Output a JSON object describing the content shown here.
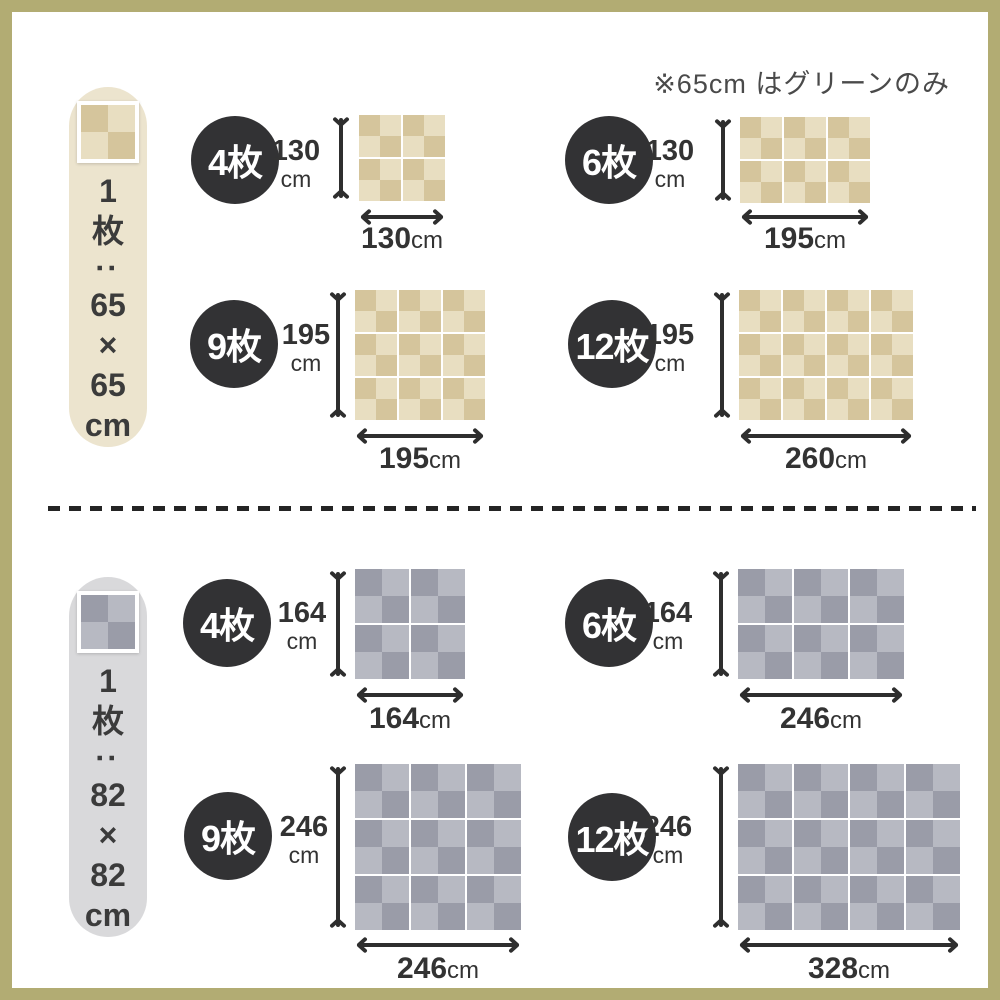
{
  "note": "※65cm はグリーンのみ",
  "colors": {
    "frame": "#b2ac73",
    "ink": "#2e2e2e",
    "circle-bg": "#323234",
    "circle-text": "#ffffff",
    "beige-dark": "#d5c59c",
    "beige-light": "#e8dec1",
    "gray-dark": "#9a9ca8",
    "gray-light": "#b7b9c2",
    "pill-65-bg": "#ece4ce",
    "pill-82-bg": "#d9d9db",
    "note-text": "#4a4a4a",
    "label-text": "#333333"
  },
  "sections": [
    {
      "piece_size": "65×65cm",
      "piece_label_chars": [
        "1",
        "枚",
        ":",
        "65",
        "×",
        "65",
        "cm"
      ],
      "layouts": [
        {
          "count": "4枚",
          "cols": 2,
          "rows": 2,
          "width": "130",
          "height": "130",
          "unit": "cm"
        },
        {
          "count": "6枚",
          "cols": 3,
          "rows": 2,
          "width": "195",
          "height": "130",
          "unit": "cm"
        },
        {
          "count": "9枚",
          "cols": 3,
          "rows": 3,
          "width": "195",
          "height": "195",
          "unit": "cm"
        },
        {
          "count": "12枚",
          "cols": 4,
          "rows": 3,
          "width": "260",
          "height": "195",
          "unit": "cm"
        }
      ]
    },
    {
      "piece_size": "82×82cm",
      "piece_label_chars": [
        "1",
        "枚",
        ":",
        "82",
        "×",
        "82",
        "cm"
      ],
      "layouts": [
        {
          "count": "4枚",
          "cols": 2,
          "rows": 2,
          "width": "164",
          "height": "164",
          "unit": "cm"
        },
        {
          "count": "6枚",
          "cols": 3,
          "rows": 2,
          "width": "246",
          "height": "164",
          "unit": "cm"
        },
        {
          "count": "9枚",
          "cols": 3,
          "rows": 3,
          "width": "246",
          "height": "246",
          "unit": "cm"
        },
        {
          "count": "12枚",
          "cols": 4,
          "rows": 3,
          "width": "328",
          "height": "246",
          "unit": "cm"
        }
      ]
    }
  ]
}
